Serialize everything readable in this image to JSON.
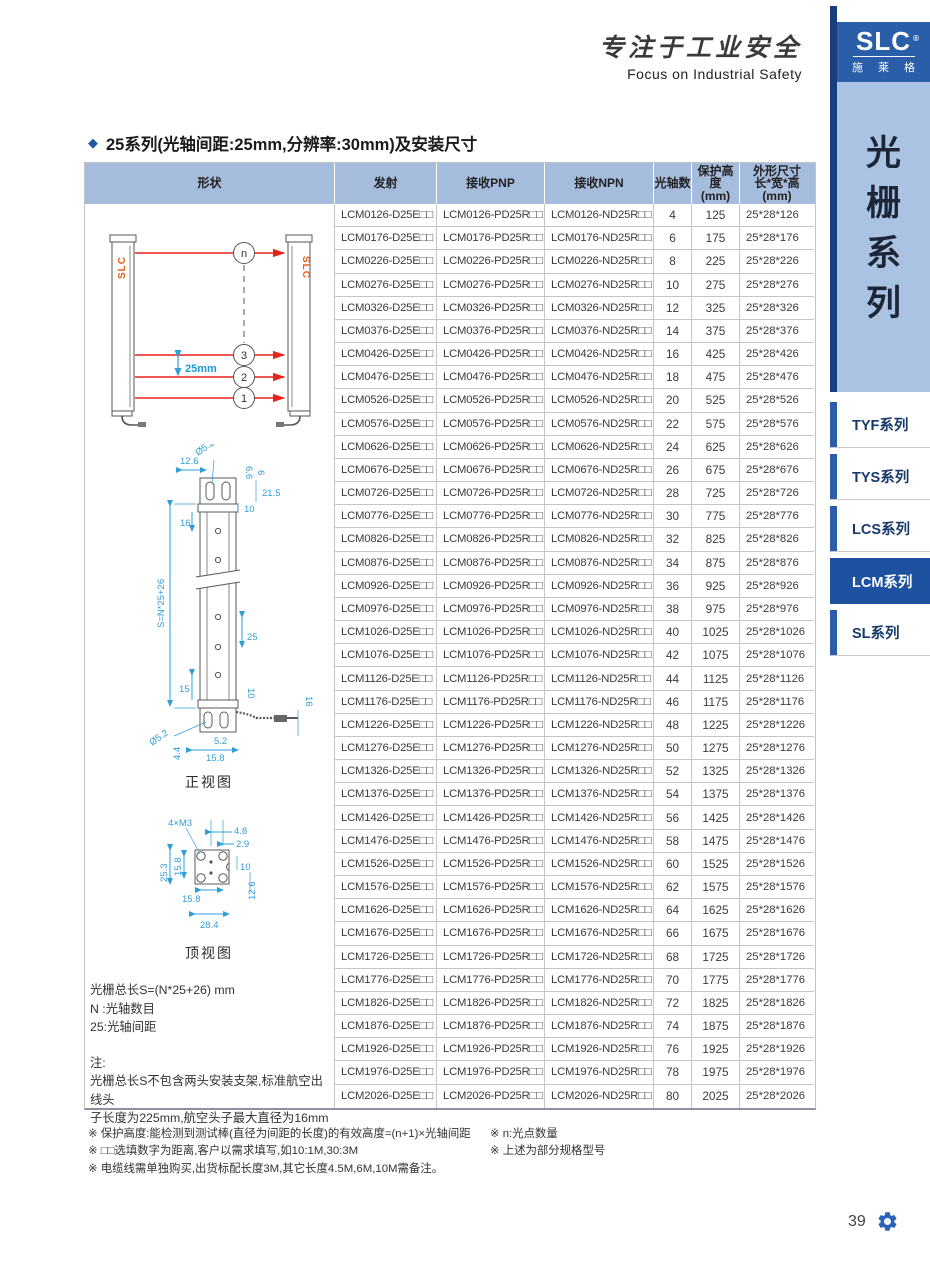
{
  "brand": {
    "calligraphy": "专注于工业安全",
    "slogan": "Focus on Industrial Safety",
    "logo_text": "SLC",
    "logo_reg": "®",
    "logo_sub": "施 莱 格"
  },
  "sidebar": {
    "vertical_title": [
      "光",
      "栅",
      "系",
      "列"
    ],
    "tabs": [
      {
        "label": "TYF系列",
        "active": false
      },
      {
        "label": "TYS系列",
        "active": false
      },
      {
        "label": "LCS系列",
        "active": false
      },
      {
        "label": "LCM系列",
        "active": true
      },
      {
        "label": "SL系列",
        "active": false
      }
    ]
  },
  "section_title": "25系列(光轴间距:25mm,分辨率:30mm)及安装尺寸",
  "table": {
    "columns": [
      "形状",
      "发射",
      "接收PNP",
      "接收NPN",
      "光轴数",
      "保护高度\n(mm)",
      "外形尺寸\n长*宽*高\n(mm)"
    ],
    "rows": [
      {
        "emitter": "LCM0126-D25E□□",
        "pnp": "LCM0126-PD25R□□",
        "npn": "LCM0126-ND25R□□",
        "axes": "4",
        "height": "125",
        "dims": "25*28*126"
      },
      {
        "emitter": "LCM0176-D25E□□",
        "pnp": "LCM0176-PD25R□□",
        "npn": "LCM0176-ND25R□□",
        "axes": "6",
        "height": "175",
        "dims": "25*28*176"
      },
      {
        "emitter": "LCM0226-D25E□□",
        "pnp": "LCM0226-PD25R□□",
        "npn": "LCM0226-ND25R□□",
        "axes": "8",
        "height": "225",
        "dims": "25*28*226"
      },
      {
        "emitter": "LCM0276-D25E□□",
        "pnp": "LCM0276-PD25R□□",
        "npn": "LCM0276-ND25R□□",
        "axes": "10",
        "height": "275",
        "dims": "25*28*276"
      },
      {
        "emitter": "LCM0326-D25E□□",
        "pnp": "LCM0326-PD25R□□",
        "npn": "LCM0326-ND25R□□",
        "axes": "12",
        "height": "325",
        "dims": "25*28*326"
      },
      {
        "emitter": "LCM0376-D25E□□",
        "pnp": "LCM0376-PD25R□□",
        "npn": "LCM0376-ND25R□□",
        "axes": "14",
        "height": "375",
        "dims": "25*28*376"
      },
      {
        "emitter": "LCM0426-D25E□□",
        "pnp": "LCM0426-PD25R□□",
        "npn": "LCM0426-ND25R□□",
        "axes": "16",
        "height": "425",
        "dims": "25*28*426"
      },
      {
        "emitter": "LCM0476-D25E□□",
        "pnp": "LCM0476-PD25R□□",
        "npn": "LCM0476-ND25R□□",
        "axes": "18",
        "height": "475",
        "dims": "25*28*476"
      },
      {
        "emitter": "LCM0526-D25E□□",
        "pnp": "LCM0526-PD25R□□",
        "npn": "LCM0526-ND25R□□",
        "axes": "20",
        "height": "525",
        "dims": "25*28*526"
      },
      {
        "emitter": "LCM0576-D25E□□",
        "pnp": "LCM0576-PD25R□□",
        "npn": "LCM0576-ND25R□□",
        "axes": "22",
        "height": "575",
        "dims": "25*28*576"
      },
      {
        "emitter": "LCM0626-D25E□□",
        "pnp": "LCM0626-PD25R□□",
        "npn": "LCM0626-ND25R□□",
        "axes": "24",
        "height": "625",
        "dims": "25*28*626"
      },
      {
        "emitter": "LCM0676-D25E□□",
        "pnp": "LCM0676-PD25R□□",
        "npn": "LCM0676-ND25R□□",
        "axes": "26",
        "height": "675",
        "dims": "25*28*676"
      },
      {
        "emitter": "LCM0726-D25E□□",
        "pnp": "LCM0726-PD25R□□",
        "npn": "LCM0726-ND25R□□",
        "axes": "28",
        "height": "725",
        "dims": "25*28*726"
      },
      {
        "emitter": "LCM0776-D25E□□",
        "pnp": "LCM0776-PD25R□□",
        "npn": "LCM0776-ND25R□□",
        "axes": "30",
        "height": "775",
        "dims": "25*28*776"
      },
      {
        "emitter": "LCM0826-D25E□□",
        "pnp": "LCM0826-PD25R□□",
        "npn": "LCM0826-ND25R□□",
        "axes": "32",
        "height": "825",
        "dims": "25*28*826"
      },
      {
        "emitter": "LCM0876-D25E□□",
        "pnp": "LCM0876-PD25R□□",
        "npn": "LCM0876-ND25R□□",
        "axes": "34",
        "height": "875",
        "dims": "25*28*876"
      },
      {
        "emitter": "LCM0926-D25E□□",
        "pnp": "LCM0926-PD25R□□",
        "npn": "LCM0926-ND25R□□",
        "axes": "36",
        "height": "925",
        "dims": "25*28*926"
      },
      {
        "emitter": "LCM0976-D25E□□",
        "pnp": "LCM0976-PD25R□□",
        "npn": "LCM0976-ND25R□□",
        "axes": "38",
        "height": "975",
        "dims": "25*28*976"
      },
      {
        "emitter": "LCM1026-D25E□□",
        "pnp": "LCM1026-PD25R□□",
        "npn": "LCM1026-ND25R□□",
        "axes": "40",
        "height": "1025",
        "dims": "25*28*1026"
      },
      {
        "emitter": "LCM1076-D25E□□",
        "pnp": "LCM1076-PD25R□□",
        "npn": "LCM1076-ND25R□□",
        "axes": "42",
        "height": "1075",
        "dims": "25*28*1076"
      },
      {
        "emitter": "LCM1126-D25E□□",
        "pnp": "LCM1126-PD25R□□",
        "npn": "LCM1126-ND25R□□",
        "axes": "44",
        "height": "1125",
        "dims": "25*28*1126"
      },
      {
        "emitter": "LCM1176-D25E□□",
        "pnp": "LCM1176-PD25R□□",
        "npn": "LCM1176-ND25R□□",
        "axes": "46",
        "height": "1175",
        "dims": "25*28*1176"
      },
      {
        "emitter": "LCM1226-D25E□□",
        "pnp": "LCM1226-PD25R□□",
        "npn": "LCM1226-ND25R□□",
        "axes": "48",
        "height": "1225",
        "dims": "25*28*1226"
      },
      {
        "emitter": "LCM1276-D25E□□",
        "pnp": "LCM1276-PD25R□□",
        "npn": "LCM1276-ND25R□□",
        "axes": "50",
        "height": "1275",
        "dims": "25*28*1276"
      },
      {
        "emitter": "LCM1326-D25E□□",
        "pnp": "LCM1326-PD25R□□",
        "npn": "LCM1326-ND25R□□",
        "axes": "52",
        "height": "1325",
        "dims": "25*28*1326"
      },
      {
        "emitter": "LCM1376-D25E□□",
        "pnp": "LCM1376-PD25R□□",
        "npn": "LCM1376-ND25R□□",
        "axes": "54",
        "height": "1375",
        "dims": "25*28*1376"
      },
      {
        "emitter": "LCM1426-D25E□□",
        "pnp": "LCM1426-PD25R□□",
        "npn": "LCM1426-ND25R□□",
        "axes": "56",
        "height": "1425",
        "dims": "25*28*1426"
      },
      {
        "emitter": "LCM1476-D25E□□",
        "pnp": "LCM1476-PD25R□□",
        "npn": "LCM1476-ND25R□□",
        "axes": "58",
        "height": "1475",
        "dims": "25*28*1476"
      },
      {
        "emitter": "LCM1526-D25E□□",
        "pnp": "LCM1526-PD25R□□",
        "npn": "LCM1526-ND25R□□",
        "axes": "60",
        "height": "1525",
        "dims": "25*28*1526"
      },
      {
        "emitter": "LCM1576-D25E□□",
        "pnp": "LCM1576-PD25R□□",
        "npn": "LCM1576-ND25R□□",
        "axes": "62",
        "height": "1575",
        "dims": "25*28*1576"
      },
      {
        "emitter": "LCM1626-D25E□□",
        "pnp": "LCM1626-PD25R□□",
        "npn": "LCM1626-ND25R□□",
        "axes": "64",
        "height": "1625",
        "dims": "25*28*1626"
      },
      {
        "emitter": "LCM1676-D25E□□",
        "pnp": "LCM1676-PD25R□□",
        "npn": "LCM1676-ND25R□□",
        "axes": "66",
        "height": "1675",
        "dims": "25*28*1676"
      },
      {
        "emitter": "LCM1726-D25E□□",
        "pnp": "LCM1726-PD25R□□",
        "npn": "LCM1726-ND25R□□",
        "axes": "68",
        "height": "1725",
        "dims": "25*28*1726"
      },
      {
        "emitter": "LCM1776-D25E□□",
        "pnp": "LCM1776-PD25R□□",
        "npn": "LCM1776-ND25R□□",
        "axes": "70",
        "height": "1775",
        "dims": "25*28*1776"
      },
      {
        "emitter": "LCM1826-D25E□□",
        "pnp": "LCM1826-PD25R□□",
        "npn": "LCM1826-ND25R□□",
        "axes": "72",
        "height": "1825",
        "dims": "25*28*1826"
      },
      {
        "emitter": "LCM1876-D25E□□",
        "pnp": "LCM1876-PD25R□□",
        "npn": "LCM1876-ND25R□□",
        "axes": "74",
        "height": "1875",
        "dims": "25*28*1876"
      },
      {
        "emitter": "LCM1926-D25E□□",
        "pnp": "LCM1926-PD25R□□",
        "npn": "LCM1926-ND25R□□",
        "axes": "76",
        "height": "1925",
        "dims": "25*28*1926"
      },
      {
        "emitter": "LCM1976-D25E□□",
        "pnp": "LCM1976-PD25R□□",
        "npn": "LCM1976-ND25R□□",
        "axes": "78",
        "height": "1975",
        "dims": "25*28*1976"
      },
      {
        "emitter": "LCM2026-D25E□□",
        "pnp": "LCM2026-PD25R□□",
        "npn": "LCM2026-ND25R□□",
        "axes": "80",
        "height": "2025",
        "dims": "25*28*2026"
      }
    ]
  },
  "shape_cell": {
    "beam_diagram": {
      "beam_labels": [
        "n",
        "3",
        "2",
        "1"
      ],
      "pitch_label": "25mm",
      "bar_logo": "SLC"
    },
    "front_view": {
      "caption": "正视图",
      "labels": {
        "dia_top": "Ø5.2",
        "d66": "6.6",
        "d6": "6",
        "d126": "12.6",
        "d215": "21.5",
        "d10_top": "10",
        "d16_top": "16",
        "total": "S=N*25+26",
        "d25": "25",
        "d15": "15",
        "d10_bot": "10",
        "d16_bot": "16",
        "dia_bot": "Ø5.2",
        "d44": "4.4",
        "d52": "5.2",
        "d158": "15.8"
      }
    },
    "top_view": {
      "caption": "顶视图",
      "labels": {
        "m3": "4×M3",
        "d48": "4.8",
        "d29": "2.9",
        "d158_left": "15.8",
        "d253": "25.3",
        "d10": "10",
        "d126": "12.6",
        "d158_bottom": "15.8",
        "d284": "28.4"
      }
    },
    "notes": {
      "formula": "光栅总长S=(N*25+26) mm",
      "n_def": "N :光轴数目",
      "pitch_def": "25:光轴间距",
      "note_title": "注:",
      "note1": "光栅总长S不包含两头安装支架,标准航空出线头",
      "note2": "子长度为225mm,航空头子最大直径为16mm"
    }
  },
  "footnotes": {
    "left": [
      "※ 保护高度:能检测到测试棒(直径为间距的长度)的有效高度=(n+1)×光轴间距",
      "※ □□选填数字为距离,客户以需求填写,如10:1M,30:3M",
      "※ 电缆线需单独购买,出货标配长度3M,其它长度4.5M,6M,10M需备注。"
    ],
    "right": [
      "※ n:光点数量",
      "※ 上述为部分规格型号"
    ]
  },
  "page_number": "39",
  "colors": {
    "accent_blue": "#2a5ea9",
    "active_tab": "#1e51a0",
    "header_bg": "#a6bcdc",
    "light_panel": "#aac3e3",
    "dim_blue": "#2f9fd8",
    "beam_red": "#e8231a",
    "bar_logo_orange": "#e8611c",
    "gear_blue": "#2a62b8"
  }
}
